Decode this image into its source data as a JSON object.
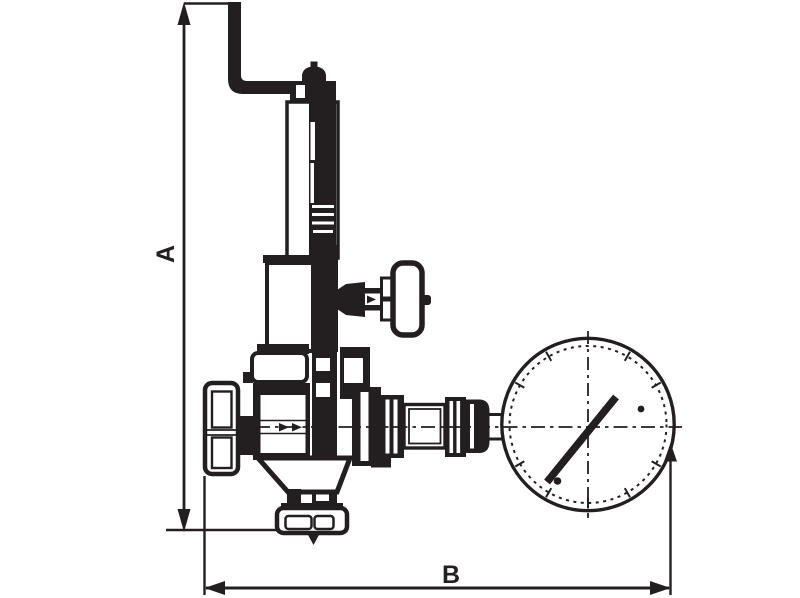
{
  "title": "valve-with-gauge-dimension-drawing",
  "labels": {
    "a": "A",
    "b": "B"
  },
  "colors": {
    "ink": "#231f20",
    "paper": "#ffffff"
  },
  "parts": [
    "dimension-a",
    "lever-pipe",
    "spring-bonnet",
    "adjusting-case",
    "test-valve",
    "inlet-handwheel",
    "valve-body",
    "bottom-flange",
    "outlet-fittings",
    "pressure-gauge",
    "flow-centerline",
    "dimension-b"
  ]
}
